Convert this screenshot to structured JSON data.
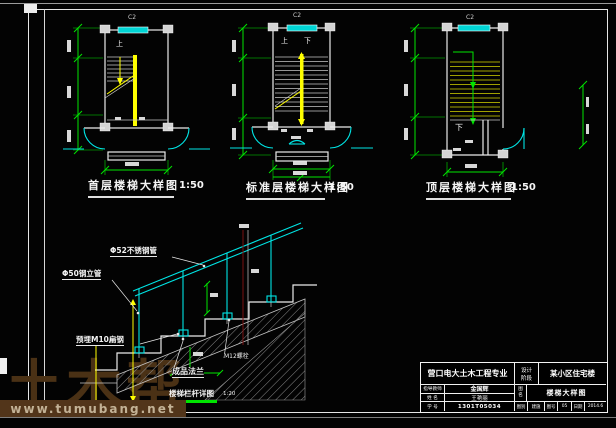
{
  "sheet": {
    "type": "CAD stair detail sheet"
  },
  "colors": {
    "background": "#030303",
    "line_white": "#ececec",
    "dimension_green": "#00e400",
    "door_window_cyan": "#00e5e5",
    "stair_yellow": "#ffff00",
    "tread_olive": "#a0a000",
    "section_red": "#7a1010",
    "watermark_brown": "#4a3115",
    "watermark_bar": "#52351a",
    "watermark_url_text": "#c3b296"
  },
  "plans": [
    {
      "title": "首层楼梯大样图",
      "scale": "1:50",
      "window_tag": "C2",
      "up_label": "上"
    },
    {
      "title": "标准层楼梯大样图",
      "scale": "1:50",
      "window_tag": "C2",
      "up_label": "上",
      "down_label": "下"
    },
    {
      "title": "顶层楼梯大样图",
      "scale": "1:50",
      "window_tag": "C2",
      "down_label": "下"
    }
  ],
  "railing_detail": {
    "title": "楼梯栏杆详图",
    "scale": "1:20",
    "labels": {
      "handrail": "Φ52不锈钢管",
      "post": "Φ50钢立管",
      "embed": "预埋M10扁钢",
      "flange": "成品法兰",
      "bolt": "M12螺栓"
    }
  },
  "title_block": {
    "department": "营口电大土木工程专业",
    "stage_top": "设计",
    "stage_bottom": "阶段",
    "project": "某小区住宅楼",
    "rows": [
      {
        "label": "指导教师",
        "value": "金国辉"
      },
      {
        "label": "姓 名",
        "value": "王艳丽"
      },
      {
        "label": "学 号",
        "value": "1301T05034"
      }
    ],
    "drawing_label": "图名",
    "drawing_name": "楼梯大样图",
    "footer": [
      {
        "label": "图别",
        "value": "建施"
      },
      {
        "label": "图号",
        "value": "05"
      },
      {
        "label": "日期",
        "value": "2014.6"
      }
    ]
  },
  "watermark": {
    "brand": "土木帮",
    "url": "www.tumubang.net"
  }
}
